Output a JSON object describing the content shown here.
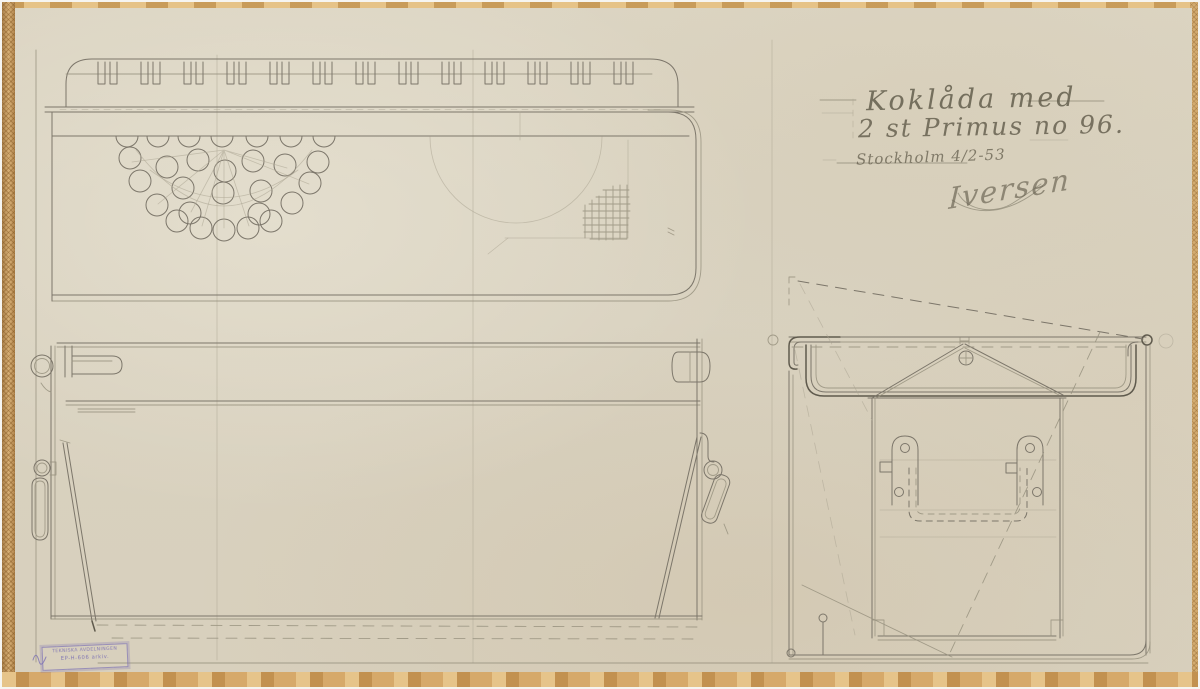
{
  "colors": {
    "paper": "#d9d2c0",
    "pencil_dark": "#5f5a4d",
    "pencil_mid": "#7c766a",
    "pencil_light": "#98927f",
    "pencil_faint": "#ada694",
    "tape": "#cfa96e",
    "stamp_ink": "#7a6fb4",
    "graphite_text": "#5f5949"
  },
  "drawing": {
    "title_line1": "Koklåda med",
    "title_line2": "2 st Primus no 96.",
    "dateline": "Stockholm 4/2-53",
    "signature": "Iversen",
    "stamp": {
      "line1": "TEKNISKA AVDELNINGEN",
      "line2": "EP-H-606 arkiv."
    }
  }
}
